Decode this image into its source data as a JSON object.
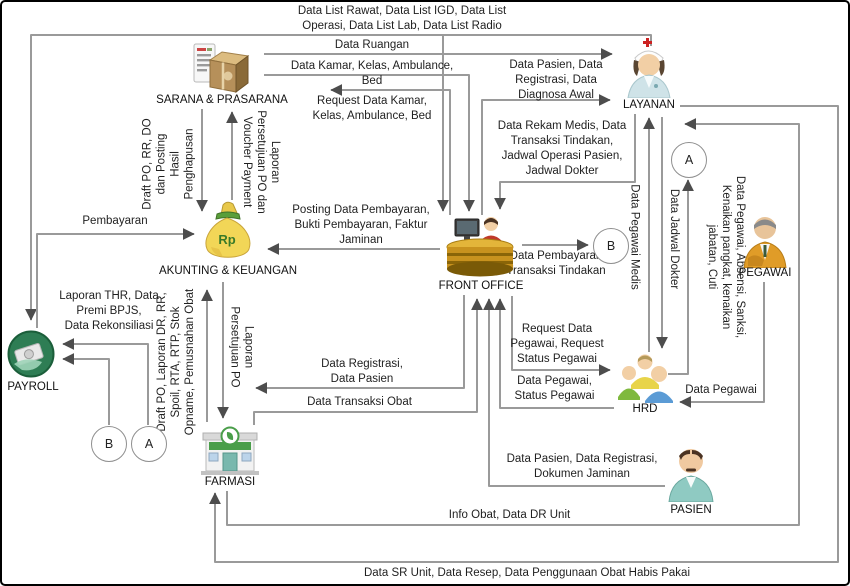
{
  "entities": {
    "sarana": {
      "label": "SARANA & PRASARANA"
    },
    "layanan": {
      "label": "LAYANAN"
    },
    "akunting": {
      "label": "AKUNTING & KEUANGAN"
    },
    "front_office": {
      "label": "FRONT OFFICE"
    },
    "payroll": {
      "label": "PAYROLL"
    },
    "farmasi": {
      "label": "FARMASI"
    },
    "hrd": {
      "label": "HRD"
    },
    "pegawai": {
      "label": "PEGAWAI"
    },
    "pasien": {
      "label": "PASIEN"
    }
  },
  "connectors": {
    "a_top": "A",
    "b_mid": "B",
    "b_left": "B",
    "a_left": "A"
  },
  "icons": {
    "rp_text": "Rp"
  },
  "colors": {
    "line": "#9a9a9a",
    "arrow": "#4d4d4d",
    "money_bag": "#f2d657",
    "payroll_green": "#2e7d54"
  },
  "flows": {
    "top_list": "Data List Rawat, Data List IGD, Data List\nOperasi, Data List Lab, Data List Radio",
    "data_ruangan": "Data Ruangan",
    "data_kamar": "Data Kamar, Kelas, Ambulance, Bed",
    "data_pasien_reg": "Data Pasien, Data\nRegistrasi, Data\nDiagnosa Awal",
    "request_kamar": "Request Data Kamar,\nKelas, Ambulance, Bed",
    "rekam_medis": "Data Rekam Medis, Data\nTransaksi Tindakan,\nJadwal Operasi Pasien,\nJadwal Dokter",
    "posting_pembayaran": "Posting Data Pembayaran,\nBukti Pembayaran, Faktur\nJaminan",
    "pembayaran_transaksi": "Data Pembayaran\nTransaksi Tindakan",
    "pembayaran": "Pembayaran",
    "laporan_thr": "Laporan THR, Data\nPremi BPJS,\nData Rekonsiliasi",
    "request_pegawai": "Request Data\nPegawai, Request\nStatus Pegawai",
    "pegawai_status": "Data Pegawai,\nStatus Pegawai",
    "data_pegawai": "Data Pegawai",
    "registrasi_pasien": "Data Registrasi,\nData Pasien",
    "transaksi_obat": "Data Transaksi Obat",
    "pasien_reg_jaminan": "Data Pasien, Data Registrasi,\nDokumen Jaminan",
    "info_obat": "Info Obat, Data DR Unit",
    "data_sr": "Data SR Unit, Data Resep, Data Penggunaan Obat Habis Pakai",
    "draft_po_rr_do": "Draft PO, RR, DO\ndan Posting\nHasil\nPenghapusan",
    "laporan_persetujuan_voucher": "Laporan\nPersetujuan PO dan\nVoucher Payment",
    "draft_po_laporan_dr": "Draft PO, Laporan DR, RR,\nSpoil, RTA, RTP, Stok\nOpname, Pemusnahan Obat",
    "laporan_persetujuan_po": "Laporan\nPersetujuan PO",
    "data_pegawai_medis": "Data Pegawai Medis",
    "data_jadwal_dokter": "Data Jadwal Dokter",
    "data_pegawai_absensi": "Data Pegawai, Absensi, Sanksi,\nKenaikan pangkat, kenaikan\njabatan, Cuti"
  }
}
